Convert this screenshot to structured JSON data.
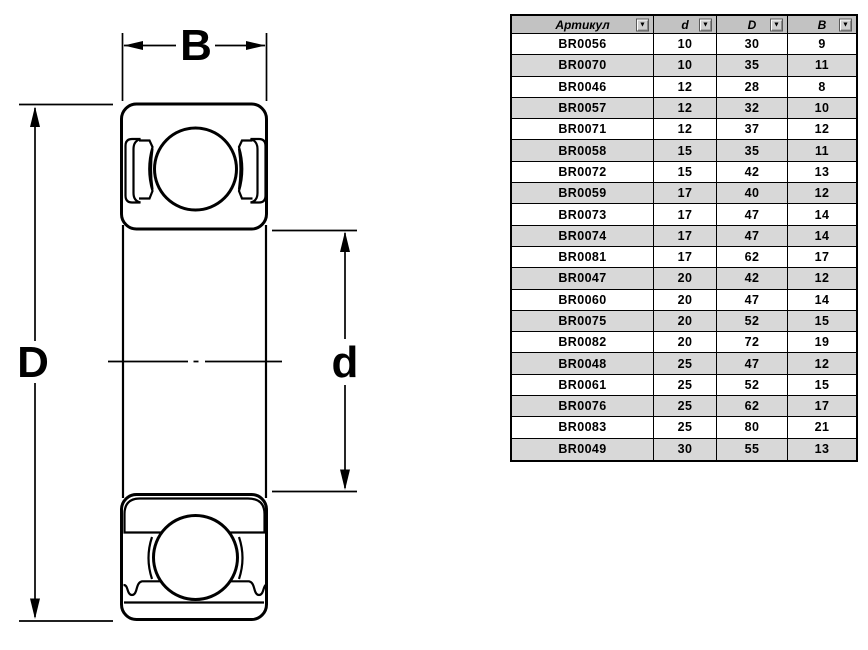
{
  "diagram": {
    "label_width": "B",
    "label_outer_diameter": "D",
    "label_inner_diameter": "d"
  },
  "table": {
    "dropdown_icon": "▼",
    "headers": [
      {
        "label": "Артикул"
      },
      {
        "label": "d"
      },
      {
        "label": "D"
      },
      {
        "label": "B"
      }
    ],
    "rows": [
      {
        "article": "BR0056",
        "d": "10",
        "D": "30",
        "B": "9"
      },
      {
        "article": "BR0070",
        "d": "10",
        "D": "35",
        "B": "11"
      },
      {
        "article": "BR0046",
        "d": "12",
        "D": "28",
        "B": "8"
      },
      {
        "article": "BR0057",
        "d": "12",
        "D": "32",
        "B": "10"
      },
      {
        "article": "BR0071",
        "d": "12",
        "D": "37",
        "B": "12"
      },
      {
        "article": "BR0058",
        "d": "15",
        "D": "35",
        "B": "11"
      },
      {
        "article": "BR0072",
        "d": "15",
        "D": "42",
        "B": "13"
      },
      {
        "article": "BR0059",
        "d": "17",
        "D": "40",
        "B": "12"
      },
      {
        "article": "BR0073",
        "d": "17",
        "D": "47",
        "B": "14"
      },
      {
        "article": "BR0074",
        "d": "17",
        "D": "47",
        "B": "14"
      },
      {
        "article": "BR0081",
        "d": "17",
        "D": "62",
        "B": "17"
      },
      {
        "article": "BR0047",
        "d": "20",
        "D": "42",
        "B": "12"
      },
      {
        "article": "BR0060",
        "d": "20",
        "D": "47",
        "B": "14"
      },
      {
        "article": "BR0075",
        "d": "20",
        "D": "52",
        "B": "15"
      },
      {
        "article": "BR0082",
        "d": "20",
        "D": "72",
        "B": "19"
      },
      {
        "article": "BR0048",
        "d": "25",
        "D": "47",
        "B": "12"
      },
      {
        "article": "BR0061",
        "d": "25",
        "D": "52",
        "B": "15"
      },
      {
        "article": "BR0076",
        "d": "25",
        "D": "62",
        "B": "17"
      },
      {
        "article": "BR0083",
        "d": "25",
        "D": "80",
        "B": "21"
      },
      {
        "article": "BR0049",
        "d": "30",
        "D": "55",
        "B": "13"
      }
    ]
  },
  "colors": {
    "line": "#000000",
    "table_border": "#000000",
    "header_bg": "#c2c2c2",
    "row_bg": "#ffffff",
    "row_alt_bg": "#d8d8d8",
    "dropdown_face": "#d0d0d0"
  }
}
